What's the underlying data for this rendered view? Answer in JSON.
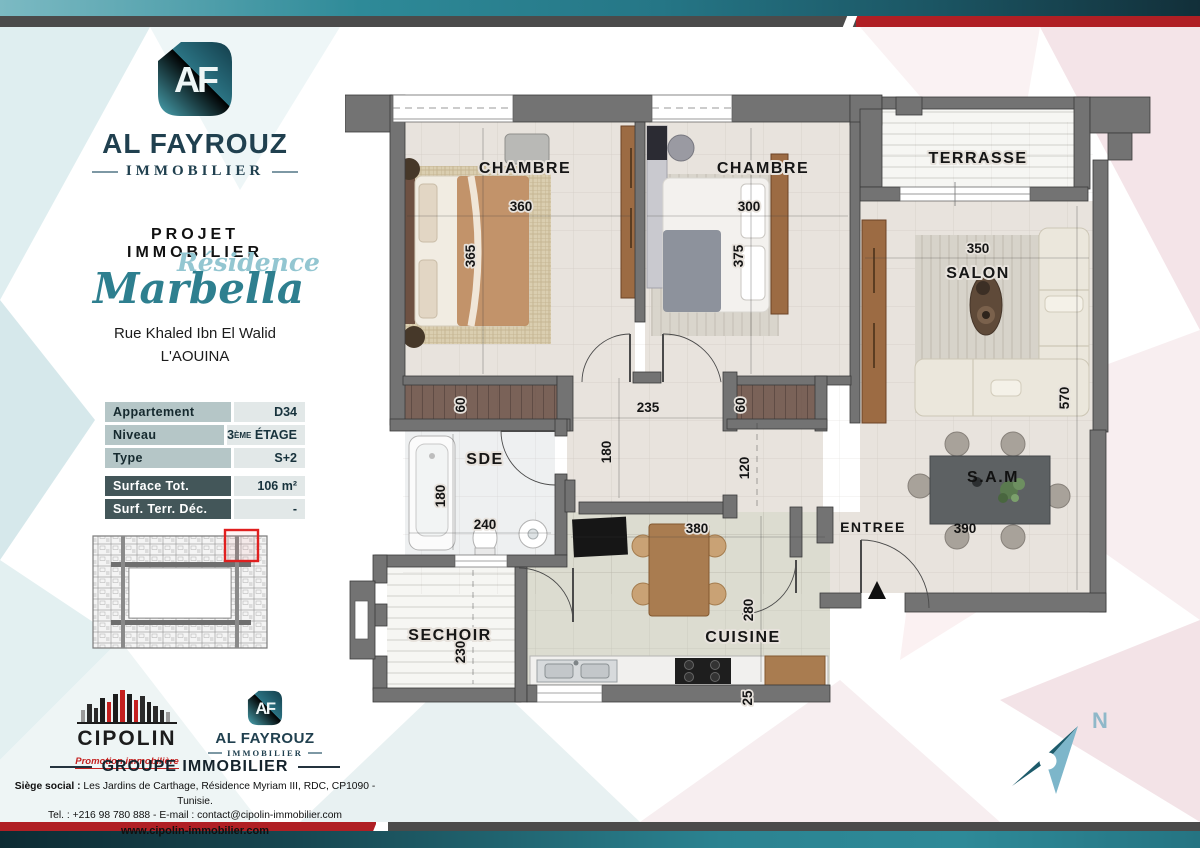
{
  "brand": {
    "monogram": "AF",
    "name": "AL FAYROUZ",
    "sub": "IMMOBILIER"
  },
  "project": {
    "kicker": "PROJET IMMOBILIER",
    "residence_script": "Résidence",
    "residence_name": "Marbella",
    "address_line1": "Rue Khaled Ibn El Walid",
    "address_line2": "L'AOUINA"
  },
  "info_table": {
    "rows": [
      {
        "label": "Appartement",
        "value": "D34"
      },
      {
        "label": "Niveau",
        "value_num": "3",
        "value_sup": "ÈME",
        "value_rest": "ÉTAGE"
      },
      {
        "label": "Type",
        "value": "S+2"
      },
      {
        "label": "Surface Tot.",
        "value": "106 m²"
      },
      {
        "label": "Surf. Terr. Déc.",
        "value": "-"
      }
    ]
  },
  "plan": {
    "rooms": {
      "chambre1": "CHAMBRE",
      "chambre2": "CHAMBRE",
      "terrasse": "TERRASSE",
      "salon": "SALON",
      "sam": "S.A.M",
      "entree": "ENTREE",
      "sde": "SDE",
      "sechoir": "SECHOIR",
      "cuisine": "CUISINE"
    },
    "dims": {
      "ch1_w": "360",
      "ch1_h": "365",
      "ch2_w": "300",
      "ch2_h": "375",
      "salon_w": "350",
      "salon_h": "570",
      "loggia1": "60",
      "loggia2": "60",
      "hall_w": "235",
      "hall_h": "180",
      "hall2_h": "120",
      "sde_h": "180",
      "sde_w": "240",
      "cuisine_w": "380",
      "cuisine_h": "280",
      "sechoir_h": "230",
      "sam_w": "390",
      "counter": "25"
    }
  },
  "compass": {
    "n": "N"
  },
  "footer": {
    "cipolin_name": "CIPOLIN",
    "cipolin_sub": "Promotion immobilière",
    "af_monogram": "AF",
    "af_name": "AL FAYROUZ",
    "af_sub": "IMMOBILIER",
    "group_title": "GROUPE IMMOBILIER",
    "address_label": "Siège social :",
    "address_rest": " Les Jardins de Carthage, Résidence Myriam III, RDC, CP1090 - Tunisie.",
    "contact": "Tel. : +216 98 780 888 -  E-mail : contact@cipolin-immobilier.com",
    "website": "www.cipolin-immobilier.com"
  },
  "colors": {
    "teal": "#2e8a98",
    "dark_teal": "#122f39",
    "red": "#b01f24",
    "gray_band": "#4b4b4b",
    "navy": "#20404f",
    "script_light": "#93c6d1",
    "script_dark": "#2e7f8f"
  }
}
